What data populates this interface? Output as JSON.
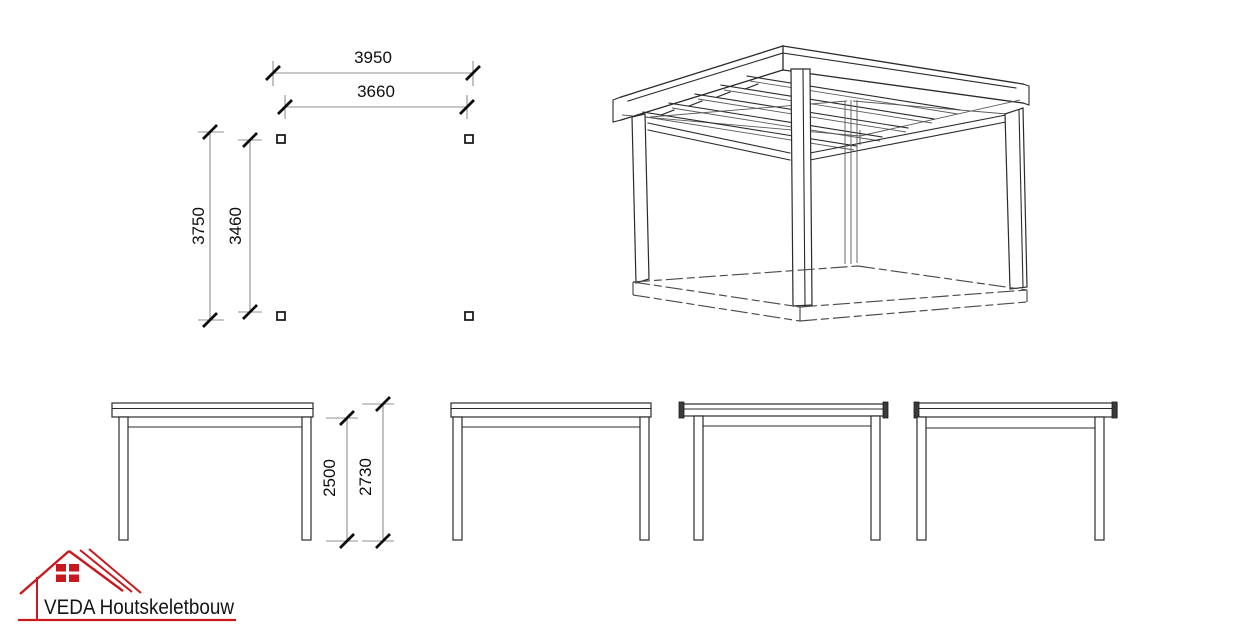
{
  "drawing": {
    "background": "#ffffff",
    "line_color": "#2b2b2b",
    "dimension_line_color": "#909090",
    "accent_red": "#c8191e"
  },
  "plan_view": {
    "dim_roof_width": "3950",
    "dim_posts_width": "3660",
    "dim_roof_depth": "3750",
    "dim_posts_depth": "3460",
    "post_markers": 4
  },
  "elevation_dims": {
    "post_height": "2500",
    "total_height": "2730"
  },
  "logo": {
    "company": "VEDA Houtskeletbouw"
  }
}
